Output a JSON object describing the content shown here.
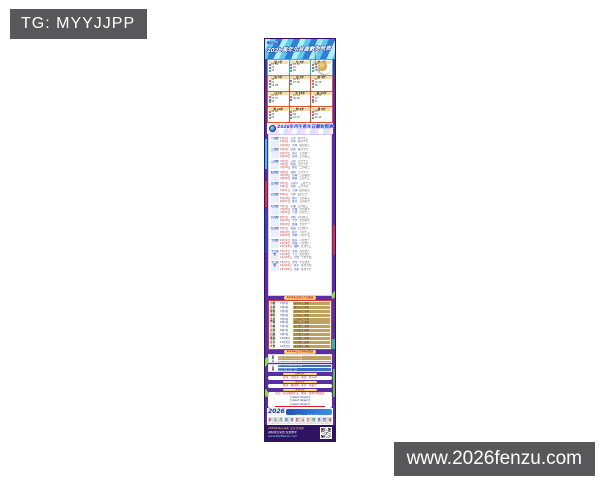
{
  "overlay": {
    "tg_label": "TG: MYYJJPP",
    "site_label": "www.2026fenzu.com"
  },
  "colors": {
    "red": "#e03030",
    "blue": "#2255cc",
    "green": "#22a044",
    "purple": "#5a2da0"
  },
  "poster": {
    "header": {
      "badge": "正版资料",
      "title": "2026馬年生肖歲數對照表"
    },
    "zodiac_cells": [
      {
        "name": "鼠",
        "age": "7岁",
        "rows": [
          {
            "c": "#e03030",
            "n": "07 19"
          },
          {
            "c": "#2255cc",
            "n": "31"
          },
          {
            "c": "#22a044",
            "n": "43"
          }
        ]
      },
      {
        "name": "牛",
        "age": "6岁",
        "rows": [
          {
            "c": "#e03030",
            "n": "18 30"
          },
          {
            "c": "#2255cc",
            "n": "42"
          },
          {
            "c": "#22a044",
            "n": "06"
          }
        ]
      },
      {
        "name": "虎",
        "age": "5岁",
        "rows": [
          {
            "c": "#e03030",
            "n": "29"
          },
          {
            "c": "#2255cc",
            "n": "41"
          },
          {
            "c": "#22a044",
            "n": "05 17"
          }
        ]
      },
      {
        "name": "兔",
        "age": "4岁",
        "rows": [
          {
            "c": "#e03030",
            "n": "40"
          },
          {
            "c": "#2255cc",
            "n": "04"
          },
          {
            "c": "#22a044",
            "n": "16 28"
          }
        ]
      },
      {
        "name": "龙",
        "age": "3岁",
        "rows": [
          {
            "c": "#2255cc",
            "n": "03 15"
          },
          {
            "c": "#22a044",
            "n": "27 39"
          }
        ]
      },
      {
        "name": "蛇",
        "age": "2岁",
        "rows": [
          {
            "c": "#e03030",
            "n": "02"
          },
          {
            "c": "#2255cc",
            "n": "14 26"
          },
          {
            "c": "#22a044",
            "n": "38"
          }
        ]
      },
      {
        "name": "马",
        "age": "1岁",
        "rows": [
          {
            "c": "#e03030",
            "n": "01 13"
          },
          {
            "c": "#2255cc",
            "n": "25 37"
          },
          {
            "c": "#22a044",
            "n": "49"
          }
        ]
      },
      {
        "name": "羊",
        "age": "12岁",
        "rows": [
          {
            "c": "#e03030",
            "n": "12 24"
          },
          {
            "c": "#2255cc",
            "n": "36 48"
          }
        ]
      },
      {
        "name": "猴",
        "age": "11岁",
        "rows": [
          {
            "c": "#e03030",
            "n": "23 35"
          },
          {
            "c": "#2255cc",
            "n": "47"
          },
          {
            "c": "#22a044",
            "n": "11"
          }
        ]
      },
      {
        "name": "鸡",
        "age": "10岁",
        "rows": [
          {
            "c": "#e03030",
            "n": "34 46"
          },
          {
            "c": "#2255cc",
            "n": "10"
          },
          {
            "c": "#22a044",
            "n": "22"
          }
        ]
      },
      {
        "name": "狗",
        "age": "9岁",
        "rows": [
          {
            "c": "#e03030",
            "n": "45"
          },
          {
            "c": "#2255cc",
            "n": "09"
          },
          {
            "c": "#22a044",
            "n": "21 33"
          }
        ]
      },
      {
        "name": "猪",
        "age": "8岁",
        "rows": [
          {
            "c": "#e03030",
            "n": "08"
          },
          {
            "c": "#2255cc",
            "n": "20"
          },
          {
            "c": "#22a044",
            "n": "32 44"
          }
        ]
      }
    ],
    "banner2": {
      "title": "2026年丙午馬年日曆對照表"
    },
    "months": [
      {
        "label": "一月份",
        "rows": [
          {
            "d": "1月1日",
            "t": "元旦",
            "r": "冬月十三"
          },
          {
            "d": "1月5日",
            "t": "小寒",
            "r": "冬月十七"
          },
          {
            "d": "1月20日",
            "t": "大寒",
            "r": "腊月初二"
          }
        ]
      },
      {
        "label": "二月份",
        "rows": [
          {
            "d": "2月4日",
            "t": "立春",
            "r": "腊月十七"
          },
          {
            "d": "2月17日",
            "t": "春节",
            "r": "正月初一"
          },
          {
            "d": "2月19日",
            "t": "雨水",
            "r": "正月初三"
          }
        ]
      },
      {
        "label": "三月份",
        "rows": [
          {
            "d": "3月3日",
            "t": "元宵",
            "r": "正月十五"
          },
          {
            "d": "3月5日",
            "t": "惊蛰",
            "r": "正月十七"
          },
          {
            "d": "3月20日",
            "t": "春分",
            "r": "二月初二"
          }
        ]
      },
      {
        "label": "四月份",
        "rows": [
          {
            "d": "4月5日",
            "t": "清明",
            "r": "二月十八"
          },
          {
            "d": "4月20日",
            "t": "谷雨",
            "r": "三月初四"
          },
          {
            "d": "4月29日",
            "t": "佛诞",
            "r": "三月十三"
          }
        ]
      },
      {
        "label": "五月份",
        "rows": [
          {
            "d": "5月1日",
            "t": "劳动节",
            "r": "三月十五"
          },
          {
            "d": "5月5日",
            "t": "立夏",
            "r": "三月十九"
          },
          {
            "d": "5月21日",
            "t": "小满",
            "r": "四月初五"
          }
        ]
      },
      {
        "label": "六月份",
        "rows": [
          {
            "d": "6月5日",
            "t": "芒种",
            "r": "四月二十"
          },
          {
            "d": "6月19日",
            "t": "端午",
            "r": "五月初五"
          },
          {
            "d": "6月21日",
            "t": "夏至",
            "r": "五月初七"
          }
        ]
      },
      {
        "label": "七月份",
        "rows": [
          {
            "d": "7月7日",
            "t": "小暑",
            "r": "五月廿三"
          },
          {
            "d": "7月23日",
            "t": "大暑",
            "r": "六月初十"
          },
          {
            "d": "7月25日",
            "t": "入伏",
            "r": "六月十二"
          }
        ]
      },
      {
        "label": "八月份",
        "rows": [
          {
            "d": "8月7日",
            "t": "立秋",
            "r": "六月廿五"
          },
          {
            "d": "8月19日",
            "t": "七夕",
            "r": "七月初七"
          },
          {
            "d": "8月23日",
            "t": "处暑",
            "r": "七月十一"
          }
        ]
      },
      {
        "label": "九月份",
        "rows": [
          {
            "d": "9月7日",
            "t": "白露",
            "r": "七月廿六"
          },
          {
            "d": "9月23日",
            "t": "秋分",
            "r": "八月十三"
          },
          {
            "d": "9月25日",
            "t": "中秋",
            "r": "八月十五"
          }
        ]
      },
      {
        "label": "十月份",
        "rows": [
          {
            "d": "10月1日",
            "t": "国庆",
            "r": "八月廿一"
          },
          {
            "d": "10月8日",
            "t": "寒露",
            "r": "八月廿八"
          },
          {
            "d": "10月23日",
            "t": "霜降",
            "r": "九月十三"
          }
        ]
      },
      {
        "label": "十一月份",
        "rows": [
          {
            "d": "11月7日",
            "t": "立冬",
            "r": "九月廿八"
          },
          {
            "d": "11月8日",
            "t": "下元",
            "r": "九月廿九"
          },
          {
            "d": "11月22日",
            "t": "小雪",
            "r": "十月十四"
          }
        ]
      },
      {
        "label": "十二月份",
        "rows": [
          {
            "d": "12月7日",
            "t": "大雪",
            "r": "十月廿九"
          },
          {
            "d": "12月22日",
            "t": "冬至",
            "r": "冬月十四"
          },
          {
            "d": "12月25日",
            "t": "圣诞",
            "r": "冬月十七"
          }
        ]
      }
    ],
    "table1": {
      "title": "2026年廿四节气对照表",
      "rows": [
        {
          "a": "小寒",
          "b": "1月5日",
          "c": "冬月十七 辰时"
        },
        {
          "a": "立春",
          "b": "2月4日",
          "c": "腊月十七 申时"
        },
        {
          "a": "惊蛰",
          "b": "3月5日",
          "c": "正月十七 子时"
        },
        {
          "a": "清明",
          "b": "4月5日",
          "c": "二月十八 卯时"
        },
        {
          "a": "立夏",
          "b": "5月5日",
          "c": "三月十九 午时"
        },
        {
          "a": "芒种",
          "b": "6月5日",
          "c": "四月二十 酉时"
        },
        {
          "a": "小暑",
          "b": "7月7日",
          "c": "五月廿三 戌时"
        },
        {
          "a": "立秋",
          "b": "8月7日",
          "c": "六月廿五 寅时"
        },
        {
          "a": "白露",
          "b": "9月7日",
          "c": "七月廿六 巳时"
        },
        {
          "a": "寒露",
          "b": "10月8日",
          "c": "八月廿八 申时"
        },
        {
          "a": "立冬",
          "b": "11月7日",
          "c": "九月廿八 亥时"
        },
        {
          "a": "大雪",
          "b": "12月7日",
          "c": "十月廿九 丑时"
        }
      ]
    },
    "table2": {
      "title": "2026年五行号码对照表",
      "block1": [
        {
          "a": "金",
          "b": "乙巳 甲子 乙丑 壬申 癸酉"
        },
        {
          "a": "木",
          "b": "戊辰 己巳 壬午 癸未 庚寅"
        },
        {
          "a": "水",
          "b": "丙午 丁未 甲寅 乙卯 壬戌"
        },
        {
          "a": "火",
          "b": "戊申 己酉 丙辰 丁巳 甲戌"
        }
      ],
      "block2": [
        {
          "a": "土",
          "b": "庚午 辛未 戊寅 己卯 丙戌"
        },
        {
          "a": "波",
          "b": "红波 蓝波 绿波 对照"
        },
        {
          "a": "合",
          "b": "单数 双数 大数 小数"
        },
        {
          "a": "肖",
          "b": "前肖 后肖 对照参考"
        }
      ]
    },
    "banners": [
      {
        "title": "四季生肖",
        "text": "春肖：虎兔龙　夏肖：蛇马羊"
      },
      {
        "title": "秋冬生肖",
        "text": "秋肖：猴鸡狗　冬肖：猪鼠牛"
      },
      {
        "title": "天地生肖",
        "text": "天肖：兔马猴猪牛龙　地肖：蛇羊鸡狗鼠虎"
      }
    ],
    "big_panel": [
      "家禽：牛马羊鸡狗猪　野兽：鼠虎兔龙蛇猴",
      "吉肖：兔龙蛇马羊鸡　凶肖：鼠牛虎猴狗猪",
      "阴肖：鼠龙蛇马狗猪　阳肖：牛虎兔羊猴鸡"
    ],
    "logo_strip": {
      "year": "2026",
      "tag": "①正版",
      "text": "马年资料大全"
    },
    "icon_strip": [
      {
        "g": "鼠",
        "n": "07",
        "c": "#e03030"
      },
      {
        "g": "牛",
        "n": "06",
        "c": "#22a044"
      },
      {
        "g": "虎",
        "n": "05",
        "c": "#22a044"
      },
      {
        "g": "兔",
        "n": "04",
        "c": "#2255cc"
      },
      {
        "g": "龙",
        "n": "03",
        "c": "#2255cc"
      },
      {
        "g": "蛇",
        "n": "02",
        "c": "#e03030"
      },
      {
        "g": "马",
        "n": "01",
        "c": "#e03030"
      },
      {
        "g": "羊",
        "n": "12",
        "c": "#e03030"
      },
      {
        "g": "猴",
        "n": "11",
        "c": "#22a044"
      },
      {
        "g": "鸡",
        "n": "10",
        "c": "#2255cc"
      },
      {
        "g": "狗",
        "n": "09",
        "c": "#2255cc"
      },
      {
        "g": "猪",
        "n": "08",
        "c": "#e03030"
      }
    ],
    "footer_lines": [
      {
        "t": "2026年丙午马年 五行天河水",
        "c": "#ffd75e"
      },
      {
        "t": "资料永久免费 仅供参考",
        "c": "#ffffff"
      },
      {
        "t": "www.2026fenzu.com",
        "c": "#7fe3ff"
      }
    ]
  }
}
